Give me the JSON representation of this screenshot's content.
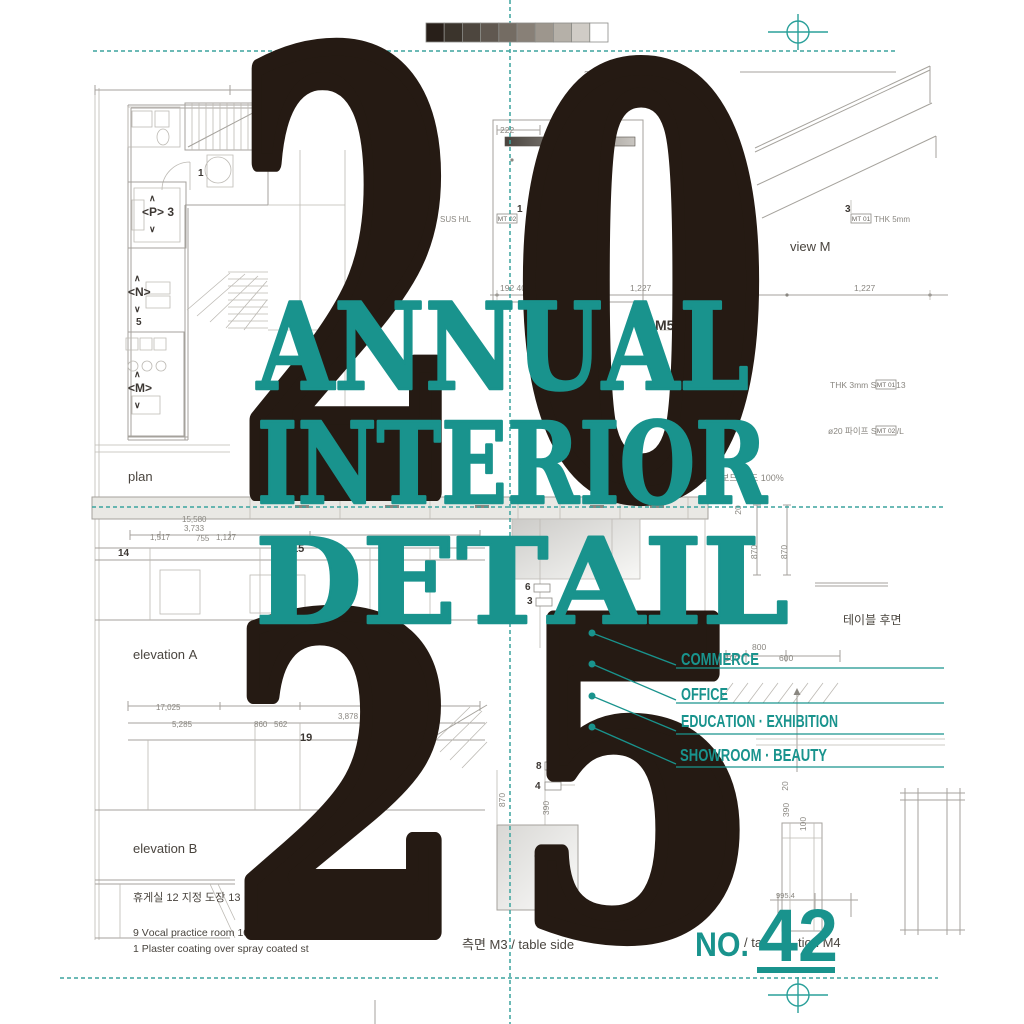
{
  "colors": {
    "teal": "#19938D",
    "ink": "#251A13",
    "line_gray": "#A5A29C"
  },
  "colorbar": {
    "swatches": [
      "#281F19",
      "#3B342C",
      "#4D463E",
      "#605850",
      "#746C63",
      "#888077",
      "#9D968D",
      "#B5B0A8",
      "#D0CCC6",
      "#FFFFFF"
    ]
  },
  "title": {
    "year_top_left": "2",
    "year_top_right": "0",
    "year_bottom_left": "2",
    "year_bottom_right": "5",
    "line1": "ANNUAL",
    "line2": "INTERIOR",
    "line3": "DETAIL"
  },
  "categories": {
    "items": [
      "COMMERCE",
      "OFFICE",
      "EDUCATION · EXHIBITION",
      "SHOWROOM · BEAUTY"
    ]
  },
  "issue": {
    "label": "NO.",
    "number": "42"
  },
  "drawing": {
    "labels": {
      "plan": "plan",
      "elevation_a": "elevation A",
      "elevation_b": "elevation B",
      "view_m": "view M",
      "table_rear": "테이블 후면",
      "caption_side": "측면 M3 / table side",
      "caption_fragment": "/ ta",
      "caption_fragment2": "tion M4",
      "m5": "M5"
    },
    "materials": {
      "note_sus": "THK 3mm SUS V13",
      "note_pipe": "ø20 파이프 SUS H/L",
      "note_thk5": "THK 5mm",
      "note_sushl": "SUS H/L",
      "note_board": "블루 보드",
      "note_pct": "도 100%",
      "tag_mt01": "MT 01",
      "tag_mt02": "MT 02",
      "tag_dap1": "DA P1"
    },
    "plan_markers": {
      "p": "<P> 3",
      "n": "<N>",
      "n_num": "5",
      "m": "<M>",
      "up": "∧",
      "down": "∨",
      "room1": "1"
    },
    "callouts": {
      "c1": "1",
      "c3": "3",
      "c4": "4",
      "c5": "5",
      "c6": "6",
      "c8": "8",
      "c14": "14",
      "c15": "15",
      "c19": "19"
    },
    "dims": {
      "d222": "222",
      "d2050": "2,050",
      "d19240": "192  40",
      "d1227": "1,227",
      "d15580": "15,580",
      "d3733": "3,733",
      "d1517": "1,517",
      "d755": "755",
      "d1127": "1,127",
      "d17025": "17,025",
      "d5285": "5,285",
      "d860": "860",
      "d562": "562",
      "d3878": "3,878",
      "d800": "800",
      "d100": "100",
      "d600": "600",
      "d870": "870",
      "d595": "595",
      "d275": "275",
      "d2900": "2,900",
      "d390": "390",
      "d20": "20",
      "d9954": "995.4"
    },
    "notes": {
      "items_kr": "휴게실    12 지정 도장    13 라인디퓨",
      "legend1": "9 Vocal practice room     10 Storage",
      "legend2": "1 Plaster coating over spray coated st"
    }
  }
}
